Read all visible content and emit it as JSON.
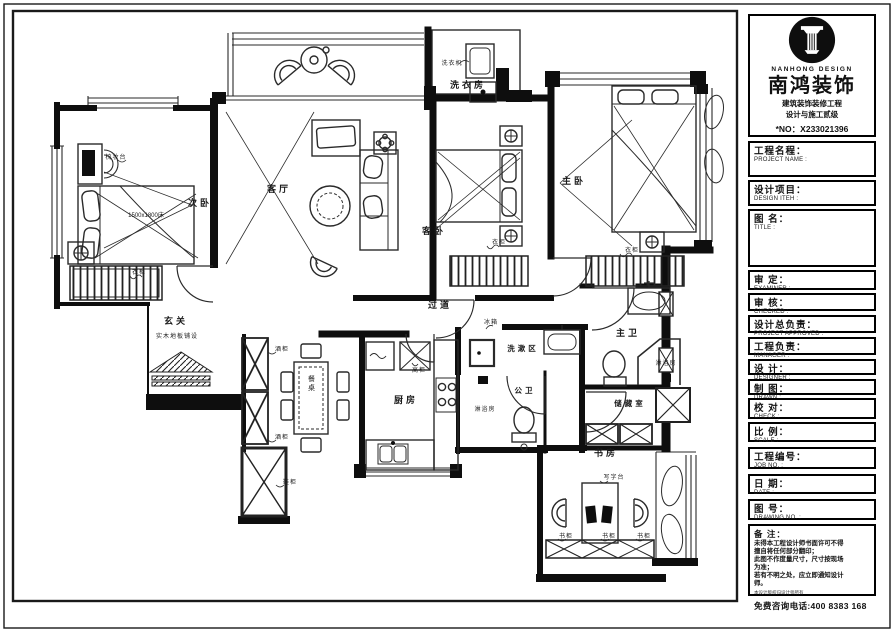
{
  "brand": {
    "name_en": "NANHONG DESIGN",
    "name_cn": "南鸿装饰",
    "sub1": "建筑装饰装修工程",
    "sub2": "设计与施工贰级",
    "license_no": "*NO：X233021396"
  },
  "title_block": {
    "fields": [
      {
        "cn": "工程名程：",
        "en": "PROJECT NAME :"
      },
      {
        "cn": "设计项目：",
        "en": "DESIGN ITEH :"
      },
      {
        "cn": "图 名：",
        "en": "TITLE :"
      },
      {
        "cn": "审 定：",
        "en": "EXAMINER :"
      },
      {
        "cn": "审 核：",
        "en": "CHECKED :"
      },
      {
        "cn": "设计总负责：",
        "en": "PROJECT APPROVED :"
      },
      {
        "cn": "工程负责：",
        "en": "MANAGER :"
      },
      {
        "cn": "设 计：",
        "en": "DESIGNER :"
      },
      {
        "cn": "制 图：",
        "en": "DRAWN :"
      },
      {
        "cn": "校 对：",
        "en": "CHECK :"
      },
      {
        "cn": "比 例：",
        "en": "SCALE :"
      },
      {
        "cn": "工程编号：",
        "en": "JOB NO. :"
      },
      {
        "cn": "日 期：",
        "en": "DATE :"
      },
      {
        "cn": "图 号：",
        "en": "DRAWING NO. :"
      }
    ],
    "notes": {
      "label": "备 注：",
      "lines": [
        "未得本工程设计师书面许可不得",
        "擅自将任何部分翻印；",
        "此图不作度量尺寸，尺寸按现场",
        "为准；",
        "若有不明之处，应立即通知设计",
        "师。"
      ],
      "fine_print": "本设计版权归设计师所有",
      "hotline": "免费咨询电话:400 8383 168"
    }
  },
  "plan": {
    "labels": [
      {
        "id": "bedroom2",
        "text": "次卧"
      },
      {
        "id": "living-room",
        "text": "客厅"
      },
      {
        "id": "laundry-room",
        "text": "洗衣房"
      },
      {
        "id": "guest-bedroom",
        "text": "客卧"
      },
      {
        "id": "master-bedroom",
        "text": "主卧"
      },
      {
        "id": "corridor",
        "text": "过道"
      },
      {
        "id": "foyer",
        "text": "玄关"
      },
      {
        "id": "kitchen",
        "text": "厨房"
      },
      {
        "id": "wash-area",
        "text": "洗漱区"
      },
      {
        "id": "public-bath",
        "text": "公卫"
      },
      {
        "id": "master-bath",
        "text": "主卫"
      },
      {
        "id": "storage-room",
        "text": "储藏室"
      },
      {
        "id": "study",
        "text": "书房"
      },
      {
        "id": "bed-size",
        "text": "1500x1800床"
      },
      {
        "id": "dresser",
        "text": "梳妆台"
      },
      {
        "id": "wardrobe-bed2",
        "text": "衣柜"
      },
      {
        "id": "wardrobe-guest",
        "text": "衣柜"
      },
      {
        "id": "wardrobe-master",
        "text": "衣柜"
      },
      {
        "id": "washing-machine",
        "text": "洗衣机"
      },
      {
        "id": "wood-floor",
        "text": "实木地板铺设"
      },
      {
        "id": "dining-table",
        "text": "餐桌"
      },
      {
        "id": "wine-cabinet-1",
        "text": "酒柜"
      },
      {
        "id": "wine-cabinet-2",
        "text": "酒柜"
      },
      {
        "id": "shoe-cabinet",
        "text": "鞋柜"
      },
      {
        "id": "tall-cabinet",
        "text": "高柜"
      },
      {
        "id": "fridge",
        "text": "冰箱"
      },
      {
        "id": "shower-public",
        "text": "淋浴房"
      },
      {
        "id": "shower-master",
        "text": "淋浴房"
      },
      {
        "id": "writing-desk",
        "text": "写字台"
      },
      {
        "id": "bookcase-1",
        "text": "书柜"
      },
      {
        "id": "bookcase-2",
        "text": "书柜"
      },
      {
        "id": "bookcase-3",
        "text": "书柜"
      }
    ]
  }
}
